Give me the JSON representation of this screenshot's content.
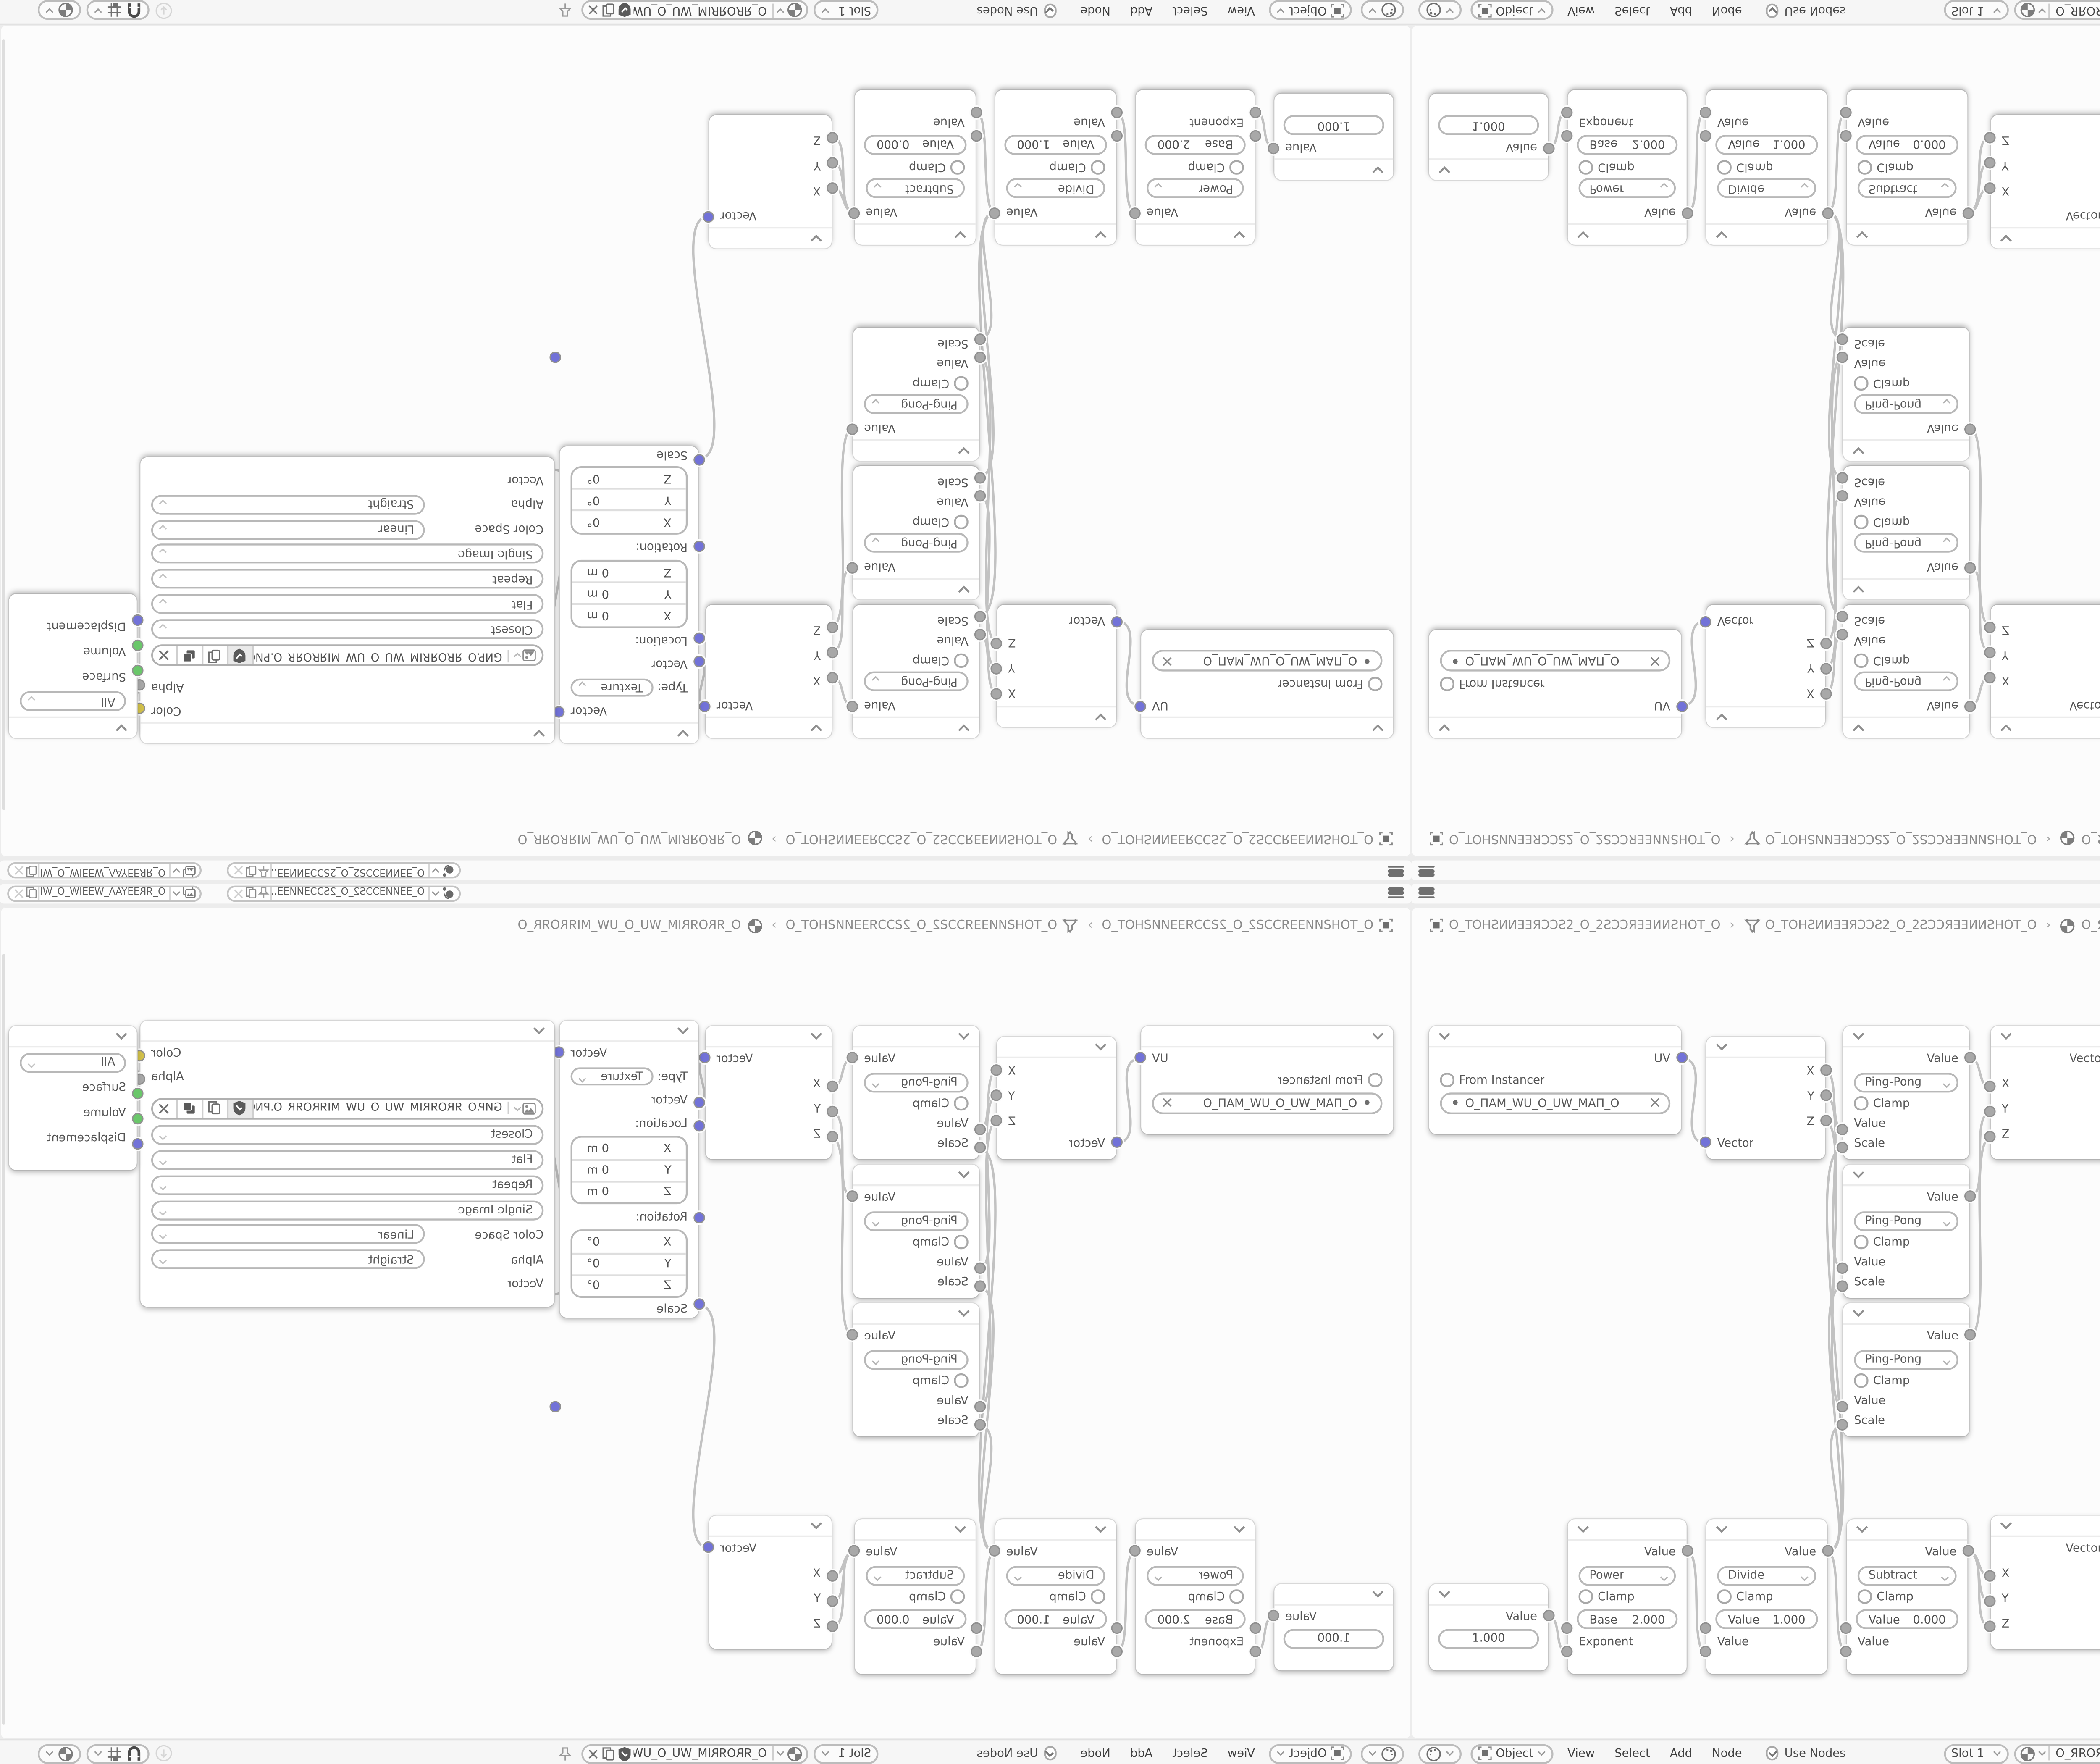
{
  "colors": {
    "canvas": "#fcfcfc",
    "header_bar": "#f6f6f6",
    "strip": "#fafafa",
    "node": "#ffffff",
    "wire": "#c2c2c2",
    "text": "#555555",
    "socket_vector": "#7272d8",
    "socket_value": "#a8a8a8",
    "socket_color": "#d2c14a",
    "socket_shader": "#6ac76a"
  },
  "topbar": {
    "scene_name": "O_ƎƎͶИƎƆƆS2_O_2SƆƆƎͶИƎƎ…",
    "view_layer_name": "O_ЯRƎƎYAΛ_WƎƎIW_O_WIƎƎW_ΛAYƎƎRЯ_O"
  },
  "breadcrumb": {
    "object_name": "O_TOHƧͶИƎƎЯƆƆƧ2_O_2ƧƆƆЯƎƎИͶƧHOT_O",
    "tree_name": "O_TOHƧͶИƎƎЯƆƆƧ2_O_2ƧƆƆЯƎƎИͶƧHOT_O",
    "material_name": "O_ЯROЯRIM_WU_O_UW_MIЯROЯR_O"
  },
  "header": {
    "shader_type": "Object",
    "menu_view": "View",
    "menu_select": "Select",
    "menu_add": "Add",
    "menu_node": "Node",
    "use_nodes": "Use Nodes",
    "slot": "Slot 1",
    "image_name": "O_ЯROЯRIM_WU_O_UW_MIЯROЯR_O"
  },
  "nodes": {
    "uv_map": {
      "output": "UV",
      "from_instancer": "From Instancer",
      "uv_name": "O_ПAM_WU_O_UW_MAП_O"
    },
    "separate_xyz": {
      "out_x": "X",
      "out_y": "Y",
      "out_z": "Z",
      "input": "Vector"
    },
    "math_pingpong": {
      "output": "Value",
      "operation": "Ping-Pong",
      "clamp": "Clamp",
      "in_value": "Value",
      "in_scale": "Scale"
    },
    "combine_xyz": {
      "output": "Vector",
      "in_x": "X",
      "in_y": "Y",
      "in_z": "Z"
    },
    "mapping": {
      "output": "Vector",
      "type_label": "Type:",
      "type_value": "Texture",
      "in_vector": "Vector",
      "location_label": "Location:",
      "loc_x_label": "X",
      "loc_x": "0 m",
      "loc_y_label": "Y",
      "loc_y": "0 m",
      "loc_z_label": "Z",
      "loc_z": "0 m",
      "rotation_label": "Rotation:",
      "rot_x_label": "X",
      "rot_x": "0°",
      "rot_y_label": "Y",
      "rot_y": "0°",
      "rot_z_label": "Z",
      "rot_z": "0°",
      "in_scale": "Scale"
    },
    "image_texture": {
      "out_color": "Color",
      "out_alpha": "Alpha",
      "filename": "GИP.O_ЯROЯRIM_WU_O_UW_MIЯROЯR_O.PNG",
      "interpolation": "Closest",
      "projection": "Flat",
      "extension": "Repeat",
      "source": "Single Image",
      "color_space_label": "Color Space",
      "color_space": "Linear",
      "alpha_label": "Alpha",
      "alpha_mode": "Straight",
      "in_vector": "Vector"
    },
    "material_output": {
      "target": "All",
      "in_surface": "Surface",
      "in_volume": "Volume",
      "in_displacement": "Displacement"
    },
    "value": {
      "output": "Value",
      "value": "1.000"
    },
    "power": {
      "output": "Value",
      "operation": "Power",
      "clamp": "Clamp",
      "field_label": "Base",
      "field_value": "2.000",
      "input": "Exponent"
    },
    "divide": {
      "output": "Value",
      "operation": "Divide",
      "clamp": "Clamp",
      "field_label": "Value",
      "field_value": "1.000",
      "input": "Value"
    },
    "subtract": {
      "output": "Value",
      "operation": "Subtract",
      "clamp": "Clamp",
      "field_label": "Value",
      "field_value": "0.000",
      "input": "Value"
    }
  }
}
